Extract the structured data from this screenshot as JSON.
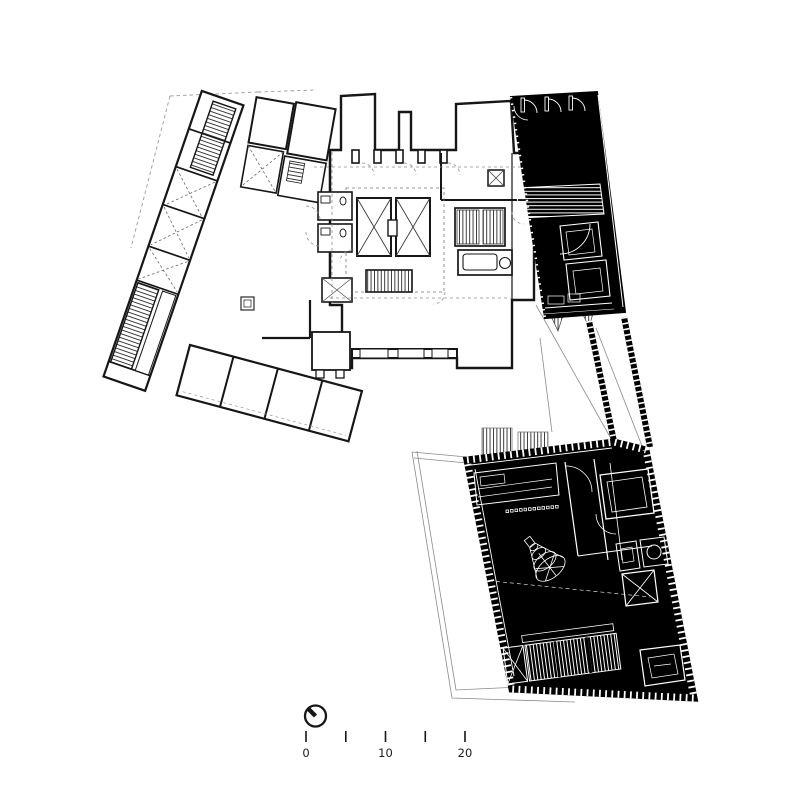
{
  "drawing": {
    "kind": "architectural-floor-plan",
    "colors": {
      "paper": "#ffffff",
      "ink": "#161616",
      "poche_fill": "#000000",
      "thin_line": "#8a8a8a",
      "dashed_line": "#9a9a9a"
    },
    "icons": {
      "north_arrow": "north-arrow-clock-icon",
      "stair_hatch": "stair-tread-hatching",
      "shaft_cross": "x-braced-shaft",
      "chandelier": "wireframe-bell-object"
    }
  },
  "scale_bar": {
    "unit_labels": [
      "0",
      "10",
      "20"
    ],
    "tick_count": 5
  }
}
